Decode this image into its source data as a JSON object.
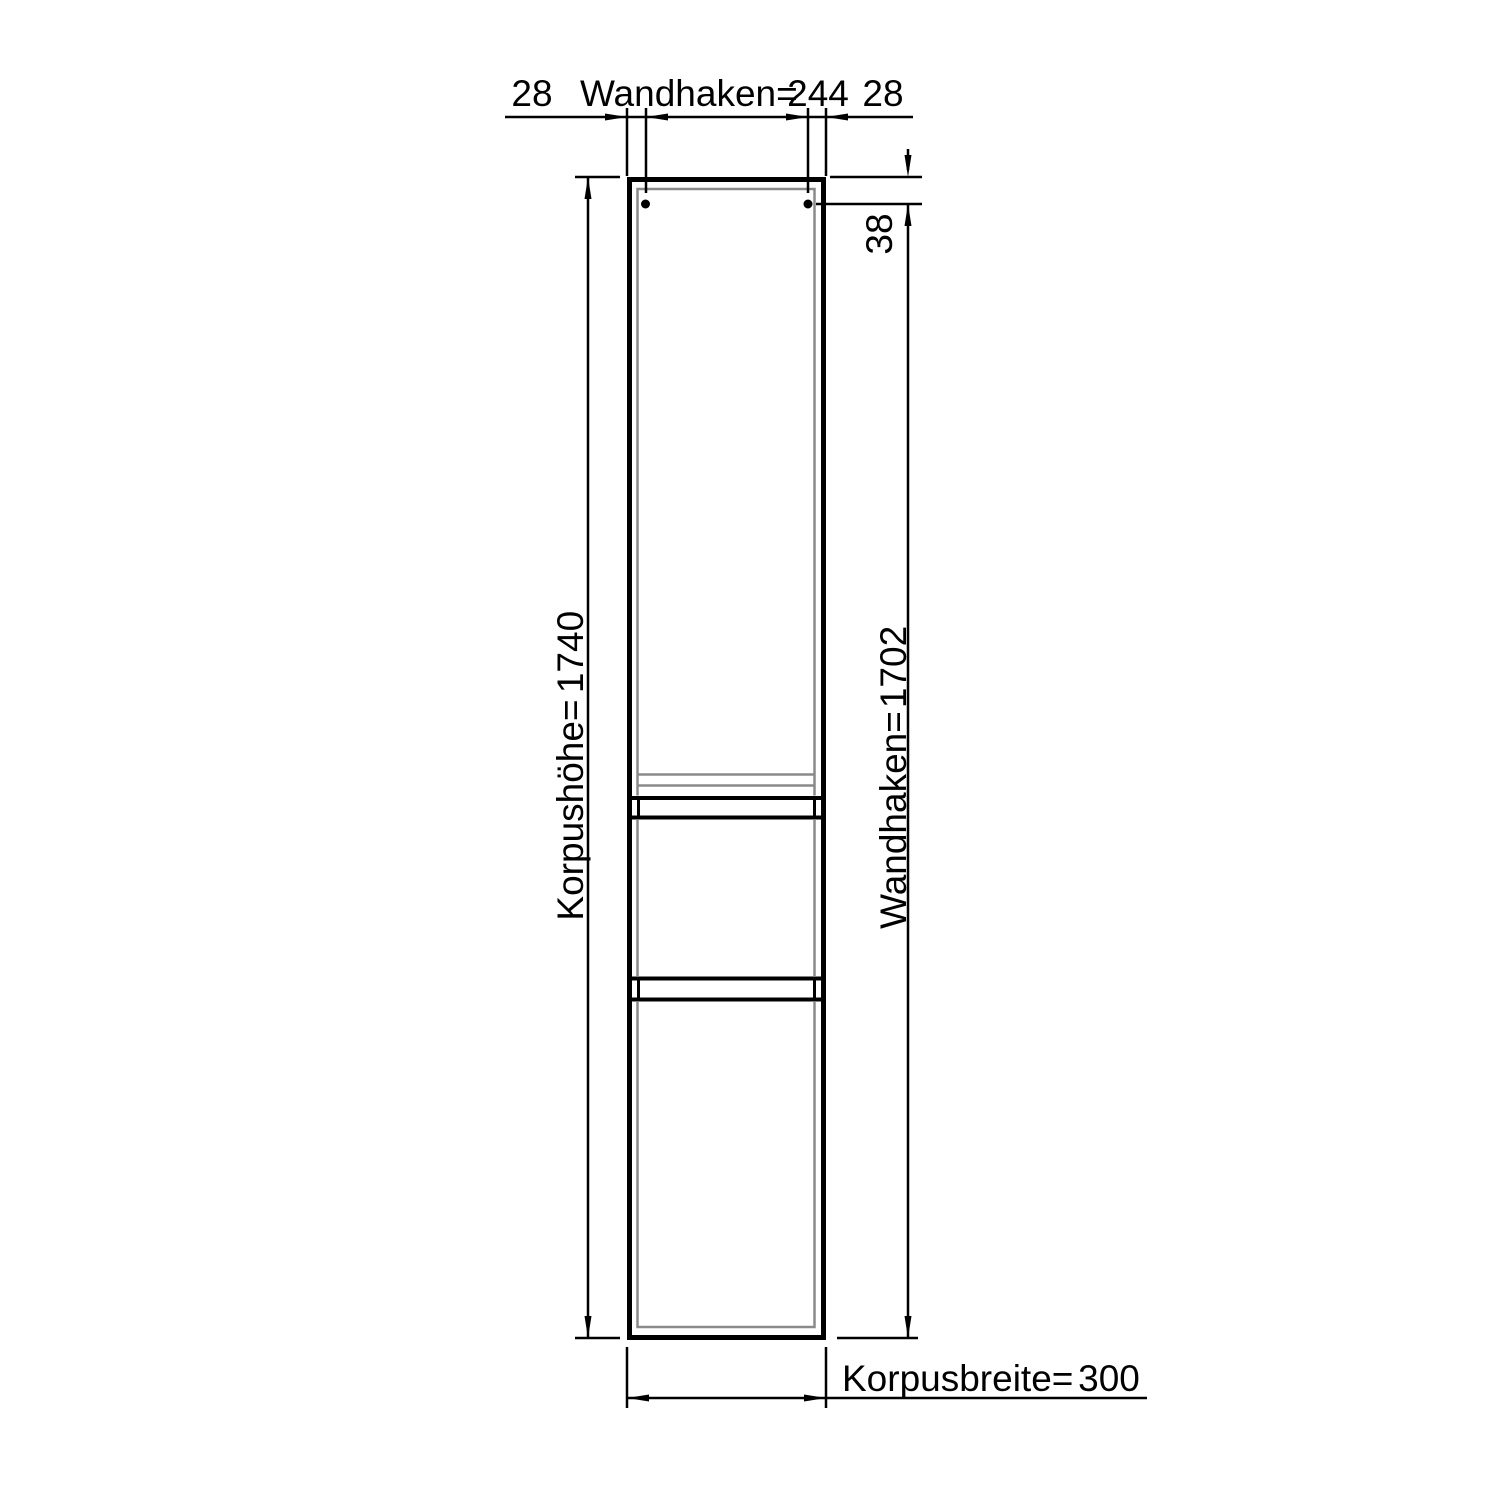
{
  "drawing": {
    "type": "technical-dimension-drawing",
    "subject": "tall-cabinet-front-elevation",
    "top_dimension": {
      "left_offset": "28",
      "label": "Wandhaken=",
      "value": "244",
      "right_offset": "28"
    },
    "hook_offset_dimension": {
      "value": "38"
    },
    "body_height_dimension": {
      "label": "Korpushöhe=",
      "value": "1740"
    },
    "hook_height_dimension": {
      "label": "Wandhaken=",
      "value": "1702"
    },
    "body_width_dimension": {
      "label": "Korpusbreite=",
      "value": "300"
    },
    "colors": {
      "line": "#000000",
      "panel_edge_gray": "#8a8a8a",
      "background": "#ffffff"
    }
  }
}
